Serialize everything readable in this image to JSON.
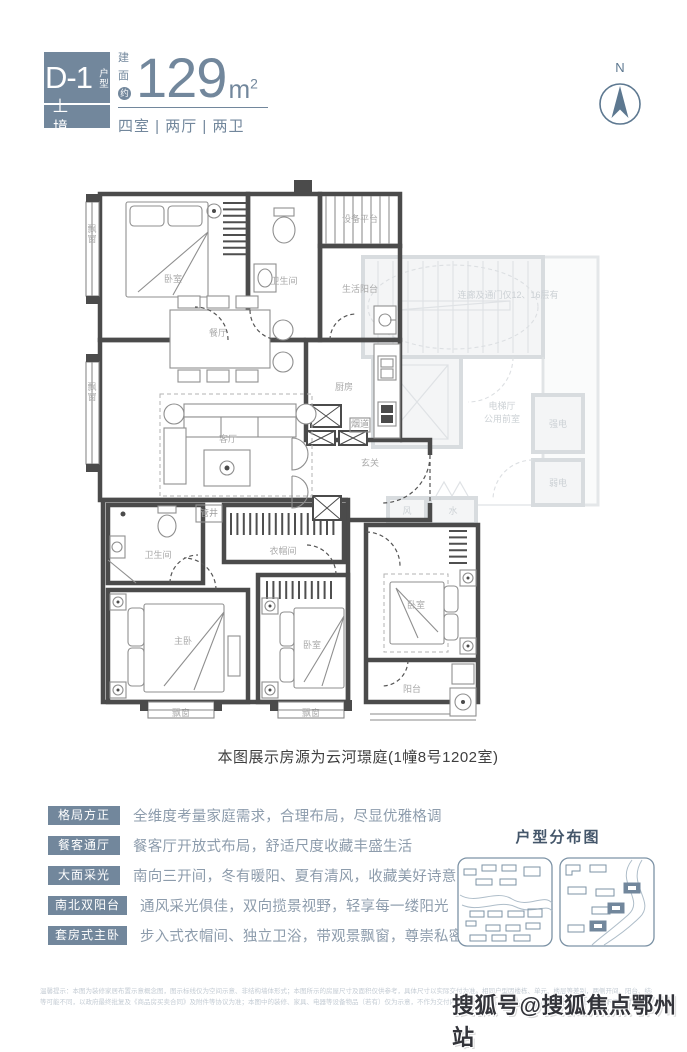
{
  "colors": {
    "accent": "#72879c",
    "accent_dark": "#5d7890",
    "wall": "#4b4b4b",
    "core_gray": "#d8dcdf",
    "desc_text": "#8d9cac",
    "caption_text": "#3f3f3f"
  },
  "header": {
    "badge": {
      "code": "D-1",
      "suffix": "户型",
      "sub": "上 境"
    },
    "area": {
      "p1": "建",
      "p2": "面",
      "p3": "约",
      "value": "129",
      "unit": "m",
      "sup": "2"
    },
    "layout_line": "四室 | 两厅 | 两卫",
    "compass_label": "N"
  },
  "floorplan": {
    "caption": "本图展示房源为云河璟庭(1幢8号1202室)",
    "labels": [
      {
        "t": "飘窗",
        "x": 14,
        "y": 70,
        "v": true
      },
      {
        "t": "卧室",
        "x": 95,
        "y": 120
      },
      {
        "t": "卫生间",
        "x": 206,
        "y": 122
      },
      {
        "t": "设备平台",
        "x": 282,
        "y": 60,
        "s": 8
      },
      {
        "t": "生活阳台",
        "x": 282,
        "y": 130,
        "s": 8
      },
      {
        "t": "餐厅",
        "x": 140,
        "y": 174
      },
      {
        "t": "厨房",
        "x": 266,
        "y": 228
      },
      {
        "t": "客厅",
        "x": 150,
        "y": 280
      },
      {
        "t": "飘窗",
        "x": 14,
        "y": 228,
        "v": true
      },
      {
        "t": "玄关",
        "x": 292,
        "y": 304
      },
      {
        "t": "烟道",
        "x": 282,
        "y": 265,
        "s": 6,
        "c": "tiny"
      },
      {
        "t": "管井",
        "x": 131,
        "y": 354,
        "s": 6.5,
        "c": "tiny"
      },
      {
        "t": "衣帽间",
        "x": 205,
        "y": 392
      },
      {
        "t": "卫生间",
        "x": 80,
        "y": 396,
        "s": 8
      },
      {
        "t": "主卧",
        "x": 105,
        "y": 482
      },
      {
        "t": "卧室",
        "x": 234,
        "y": 486
      },
      {
        "t": "卧室",
        "x": 338,
        "y": 446
      },
      {
        "t": "阳台",
        "x": 334,
        "y": 530
      },
      {
        "t": "飘窗",
        "x": 103,
        "y": 554,
        "s": 8
      },
      {
        "t": "飘窗",
        "x": 233,
        "y": 554,
        "s": 8
      },
      {
        "t": "连廊及通门仅12、16层有",
        "x": 430,
        "y": 136,
        "s": 6.5,
        "c": "core"
      },
      {
        "t": "电梯厅",
        "x": 424,
        "y": 247,
        "s": 8.5,
        "c": "core"
      },
      {
        "t": "公用前室",
        "x": 424,
        "y": 260,
        "s": 8.5,
        "c": "core"
      },
      {
        "t": "强电",
        "x": 480,
        "y": 265,
        "s": 8,
        "c": "core"
      },
      {
        "t": "弱电",
        "x": 480,
        "y": 324,
        "s": 8,
        "c": "core"
      },
      {
        "t": "风",
        "x": 329,
        "y": 352,
        "s": 8,
        "c": "core"
      },
      {
        "t": "水",
        "x": 375,
        "y": 352,
        "s": 8,
        "c": "core"
      }
    ]
  },
  "features": {
    "items": [
      {
        "tag": "格局方正",
        "desc": "全维度考量家庭需求，合理布局，尽显优雅格调"
      },
      {
        "tag": "餐客通厅",
        "desc": "餐客厅开放式布局，舒适尺度收藏丰盛生活"
      },
      {
        "tag": "大面采光",
        "desc": "南向三开间，冬有暖阳、夏有清风，收藏美好诗意"
      },
      {
        "tag": "南北双阳台",
        "desc": "通风采光俱佳，双向揽景视野，轻享每一缕阳光"
      },
      {
        "tag": "套房式主卧",
        "desc": "步入式衣帽间、独立卫浴，带观景飘窗，尊崇私密享受"
      }
    ]
  },
  "distribution": {
    "title": "户型分布图"
  },
  "footer": {
    "disclaimer_line1": "温馨提示：本图为装修家居布置示意概念图，图示标线仅为空间示意、非结构墙体形式；本图所示的房屋尺寸及面积仅供参考，具体尺寸以实际交付为准。相同户型因楼栋、单元、楼层等差别，两侧开间、阳台、结构、采阳、管道位置、外立面、设备平台",
    "disclaimer_line2": "等可能不同，以政府最终批复及《商品房买卖合同》及附件等协议为准；本图中的装修、家具、电器等设备物品（若有）仅为示意，不作为交付内容和交付标准。出卖人在不违反国家法律法规的前提下保留对本资料的解释权。",
    "watermark": "搜狐号@搜狐焦点鄂州站"
  }
}
